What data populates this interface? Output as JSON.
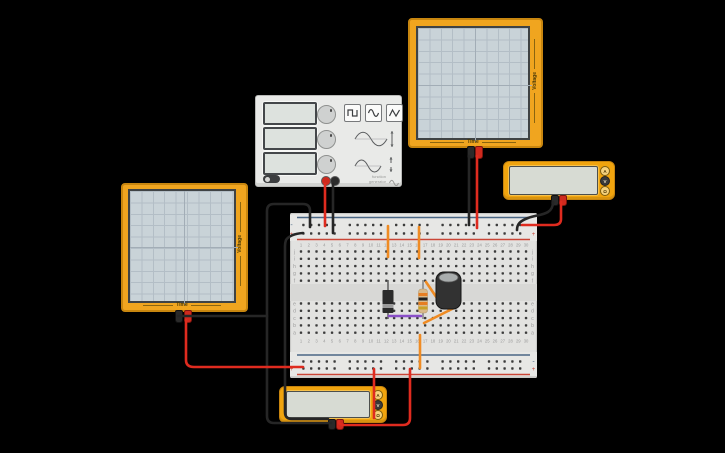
{
  "app": {
    "description": "circuit simulation workspace",
    "background": "#000000"
  },
  "oscilloscope_left": {
    "time_label": "Time",
    "voltage_label": "Voltage"
  },
  "oscilloscope_top": {
    "time_label": "Time",
    "voltage_label": "Voltage"
  },
  "function_generator": {
    "label_line1": "function",
    "label_line2": "generator",
    "wave_buttons": [
      "square-wave",
      "sine-wave",
      "triangle-wave"
    ],
    "displays": [
      "",
      "",
      ""
    ],
    "knobs": [
      "frequency-knob",
      "amplitude-knob",
      "offset-knob"
    ],
    "power_toggle": "on",
    "terminals": [
      "red",
      "black"
    ]
  },
  "multimeter_right": {
    "buttons": [
      "A",
      "V",
      "Ω"
    ],
    "selected": "V",
    "display_value": ""
  },
  "multimeter_bottom": {
    "buttons": [
      "A",
      "V",
      "Ω"
    ],
    "selected": "V",
    "display_value": ""
  },
  "circuit": {
    "colors": {
      "black": "#262626",
      "red": "#df2b1f",
      "orange": "#ef8b23",
      "purple": "#8a4fc8",
      "rail_blue": "#4a6785",
      "rail_red": "#c94536",
      "hole": "#3b3b3b",
      "label": "#9a9a9a"
    },
    "breadboard": {
      "x": 290,
      "y": 213,
      "w": 247,
      "h": 165,
      "lineX1": 297,
      "lineX2": 530,
      "railTop": {
        "blueY": 217.5,
        "minusY": 225,
        "plusY": 233.5,
        "redY": 239.5
      },
      "railBottom": {
        "blueY": 355,
        "minusY": 361.5,
        "plusY": 368.5,
        "redY": 374.5
      },
      "railHoleStart": 303.4,
      "railGroupPitch": 46.4,
      "railHolePitch": 7.8,
      "cols": 30,
      "colStart": 301,
      "colPitch": 7.76,
      "topRowsY": [
        251.5,
        258.8,
        266.1,
        273.4,
        280.7
      ],
      "bottomRowsY": [
        303.5,
        310.8,
        318.1,
        325.4,
        332.7
      ],
      "numTopY": 246.5,
      "numBotY": 342.5,
      "letterLeftX": 294.5,
      "letterRightX": 532.5,
      "markerLeftX": 291.5,
      "markerRightX": 533.5,
      "row_letters_top": [
        "j",
        "i",
        "h",
        "g",
        "f"
      ],
      "row_letters_bottom": [
        "e",
        "d",
        "c",
        "b",
        "a"
      ],
      "minus_marker": "-",
      "plus_marker": "+"
    },
    "components": [
      {
        "type": "diode",
        "name": "diode",
        "layer": "under",
        "x": 388,
        "bodyY1": 290,
        "bodyY2": 313,
        "stripeY": 304,
        "leadY1": 280,
        "leadY2": 319,
        "bodyColor": "#2b2b2b",
        "stripeColor": "#9b9b9b"
      },
      {
        "type": "resistor",
        "name": "resistor",
        "layer": "under",
        "x": 423,
        "bodyY1": 289,
        "bodyY2": 313,
        "leadY1": 280,
        "leadY2": 319,
        "bodyColor": "#d9b98a",
        "bands": [
          "#e67e22",
          "#1e1e1e",
          "#e67e22",
          "#c9a227"
        ]
      },
      {
        "type": "capacitor",
        "name": "electrolytic-capacitor",
        "layer": "over",
        "x1": 436,
        "y1": 272,
        "x2": 461,
        "y2": 309,
        "bodyColor": "#323232",
        "topColor": "#a9adad"
      }
    ],
    "wires": [
      {
        "name": "wire-osc-left-black",
        "color": "black",
        "path": "M178,316 L267,316"
      },
      {
        "name": "wire-black-to-top-minus-rail",
        "color": "black",
        "path": "M310,227 L310,211 Q310,204 303,204 L274,204 Q267,204 267,211 L267,416 Q267,423 274,423 L331,423"
      },
      {
        "name": "wire-black-to-top-plus-rail",
        "color": "black",
        "path": "M303,233 Q290,234 286,240 Q285,243 285,246 L285,412 Q285,419 292,419 L328,419"
      },
      {
        "name": "wire-fgen-black",
        "color": "black",
        "path": "M333,184 L333,233"
      },
      {
        "name": "wire-fgen-red",
        "color": "red",
        "path": "M325,184 L325,226"
      },
      {
        "name": "wire-osc-top-black",
        "color": "black",
        "path": "M469,156 L469,225"
      },
      {
        "name": "wire-osc-top-red",
        "color": "red",
        "path": "M477,156 L477,228"
      },
      {
        "name": "wire-mm-right-black",
        "color": "black",
        "path": "M553,202 C553,216 538,214 528,218 C520,221 517,224 517,230"
      },
      {
        "name": "wire-mm-right-red",
        "color": "red",
        "path": "M561,202 L561,219 Q561,225 554,225 L522,225"
      },
      {
        "name": "wire-osc-left-red",
        "color": "red",
        "path": "M186,320 L186,360 Q186,367 194,367 L303,367"
      },
      {
        "name": "wire-mm-bottom-red",
        "color": "red",
        "path": "M339,421 L339,422 Q339,425 345,425 L403,425 Q410,425 410,418 L410,369"
      },
      {
        "name": "wire-red-rail-stub",
        "color": "red",
        "path": "M374,369 L374,418"
      },
      {
        "name": "wire-orange-signal-col13",
        "color": "orange",
        "path": "M388,226 L388,257"
      },
      {
        "name": "wire-orange-signal-col17",
        "color": "orange",
        "path": "M419,227 L419,258"
      },
      {
        "name": "wire-orange-to-bottom-rail",
        "color": "orange",
        "path": "M420,335 L420,368"
      },
      {
        "name": "wire-orange-diag-cap-left",
        "color": "orange",
        "path": "M426,282 L439,301"
      },
      {
        "name": "wire-orange-diag-cap-right",
        "color": "orange",
        "path": "M454,308 L424,323"
      },
      {
        "name": "wire-purple-diode-to-resistor",
        "color": "purple",
        "path": "M389,316 L421,316"
      }
    ]
  }
}
